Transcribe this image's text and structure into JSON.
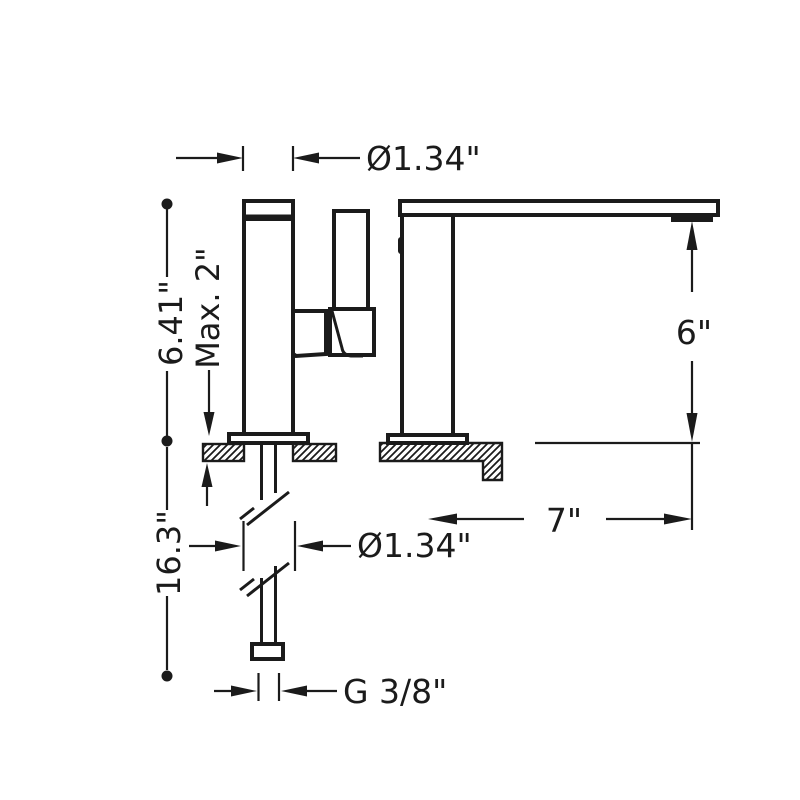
{
  "diagram": {
    "type": "faucet-installation-dimension-drawing",
    "colors": {
      "line": "#1b1b1b",
      "background": "#ffffff"
    },
    "labels": {
      "body_diameter_top": "Ø1.34\"",
      "total_height": "6.41\"",
      "max_deck_thickness": "Max. 2\"",
      "spout_height": "6\"",
      "total_depth_with_supply": "16.3\"",
      "shank_diameter": "Ø1.34\"",
      "spout_reach": "7\"",
      "supply_connection_thread": "G 3/8\""
    }
  }
}
